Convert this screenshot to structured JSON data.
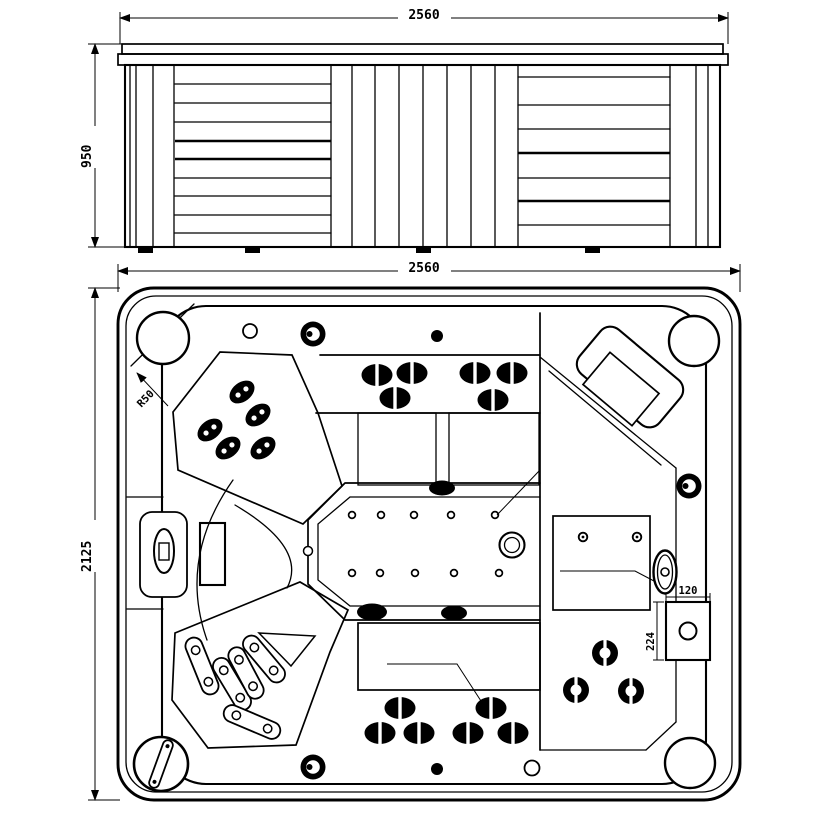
{
  "side_view": {
    "dim_width": "2560",
    "dim_height": "950"
  },
  "plan_view": {
    "dim_width": "2560",
    "dim_depth": "2125",
    "corner_radius_label": "R50",
    "control_box": {
      "dim_width": "120",
      "dim_height": "224"
    }
  },
  "icons": {
    "jet": "oval-hydro-jet",
    "round_jet": "round-hydro-jet",
    "power_jet": "power-ring-jet",
    "drain": "double-circle-drain",
    "valve": "filter-valve-handle"
  },
  "colors": {
    "line": "#000000",
    "background": "#ffffff"
  }
}
